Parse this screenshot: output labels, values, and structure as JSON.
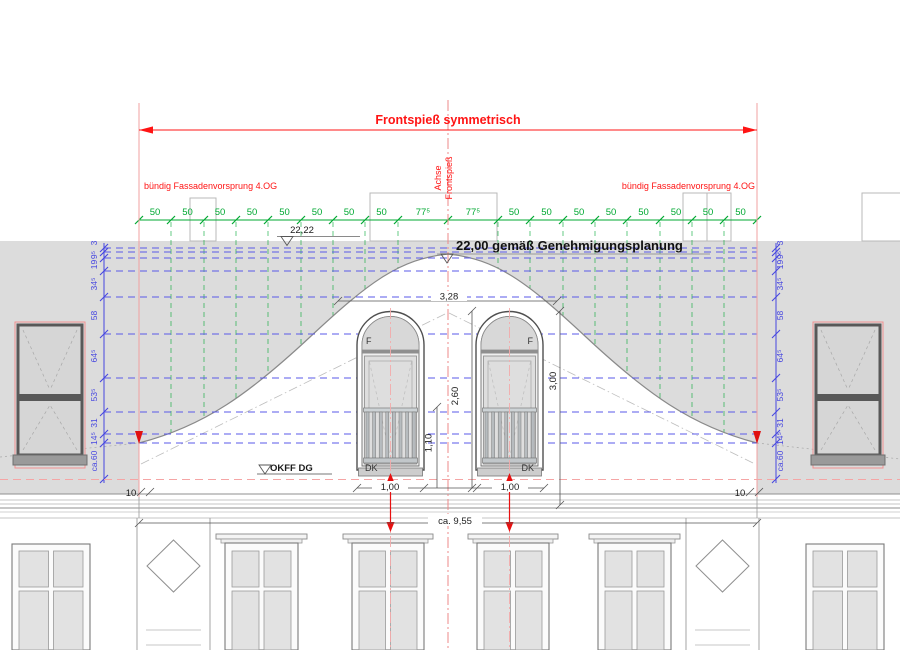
{
  "drawing": {
    "top_dimension_label": "Frontspieß symmetrisch",
    "axis": {
      "line1": "Achse",
      "line2": "Frontspieß"
    },
    "notes": {
      "flush_left": "bündig Fassadenvorsprung 4.OG",
      "flush_right": "bündig Fassadenvorsprung 4.OG"
    },
    "levels": {
      "level_2222": "22,22",
      "level_2200": "22,00 gemäß Genehmigungsplanung",
      "okff": "OKFF DG"
    },
    "dims": {
      "total_width": "ca. 9,55",
      "w328": "3,28",
      "h260": "2,60",
      "h110": "1,10",
      "h300": "3,00",
      "w100_left": "1,00",
      "w100_right": "1,00",
      "side10_left": "10",
      "side10_right": "10"
    },
    "green_chain": [
      "50",
      "50",
      "50",
      "50",
      "50",
      "50",
      "50",
      "50",
      "77⁵",
      "77⁵",
      "50",
      "50",
      "50",
      "50",
      "50",
      "50",
      "50",
      "50"
    ],
    "blue_chain_left": [
      "3",
      "9⁵",
      "19",
      "34⁵",
      "58",
      "64⁵",
      "53⁵",
      "31",
      "14⁵",
      "ca.60"
    ],
    "blue_chain_right": [
      "3",
      "9⁵",
      "19",
      "34⁵",
      "58",
      "64⁵",
      "53⁵",
      "31",
      "14⁵",
      "ca.60"
    ],
    "gable_windows": {
      "left": {
        "f": "F",
        "dk": "DK"
      },
      "right": {
        "f": "F",
        "dk": "DK"
      }
    },
    "colors": {
      "dim_red": "#ff1414",
      "axis_pink": "#f0909a",
      "green": "#00a832",
      "blue": "#4646e0",
      "facade_gray": "#dcdcdc",
      "line_gray": "#8a8a8a"
    }
  }
}
